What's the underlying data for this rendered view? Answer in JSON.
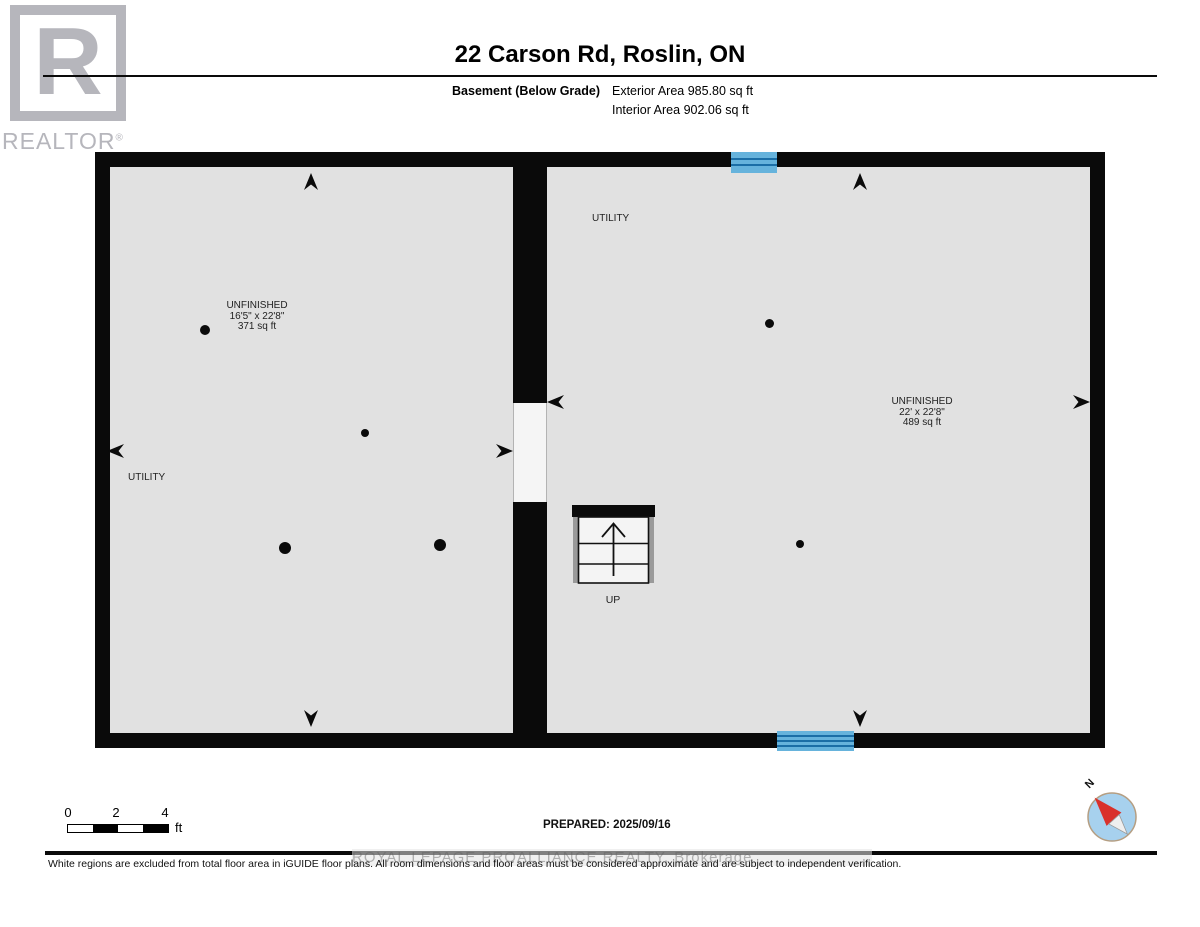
{
  "logo": {
    "letter": "R",
    "brand": "REALTOR",
    "registered": "®"
  },
  "header": {
    "title": "22 Carson Rd, Roslin, ON",
    "floor_label": "Basement (Below Grade)",
    "exterior_area": "Exterior Area 985.80 sq ft",
    "interior_area": "Interior Area 902.06 sq ft"
  },
  "floorplan": {
    "rooms": [
      {
        "name": "UNFINISHED",
        "dimensions": "16'5\" x 22'8\"",
        "area": "371 sq ft",
        "utility_label": "UTILITY"
      },
      {
        "name": "UNFINISHED",
        "dimensions": "22' x 22'8\"",
        "area": "489 sq ft",
        "utility_label": "UTILITY"
      }
    ],
    "stairs": {
      "label": "UP"
    }
  },
  "footer": {
    "scale": {
      "ticks": [
        "0",
        "2",
        "4"
      ],
      "unit": "ft"
    },
    "prepared": "PREPARED: 2025/09/16",
    "compass": {
      "north": "N"
    },
    "watermark": "ROYAL LEPAGE PROALLIANCE REALTY, Brokerage",
    "disclaimer": "White regions are excluded from total floor area in iGUIDE floor plans. All room dimensions and floor areas must be considered approximate and are subject to independent verification."
  },
  "colors": {
    "wall": "#0a0a0a",
    "room_fill": "#e1e1e1",
    "opening_fill": "#f5f5f5",
    "window_light": "#66b3dc",
    "window_dark": "#1b6ea6",
    "logo_gray": "#b6b6bc",
    "compass_blue": "#a7d1ee",
    "compass_red": "#d9312b",
    "compass_ring": "#b59e82"
  }
}
